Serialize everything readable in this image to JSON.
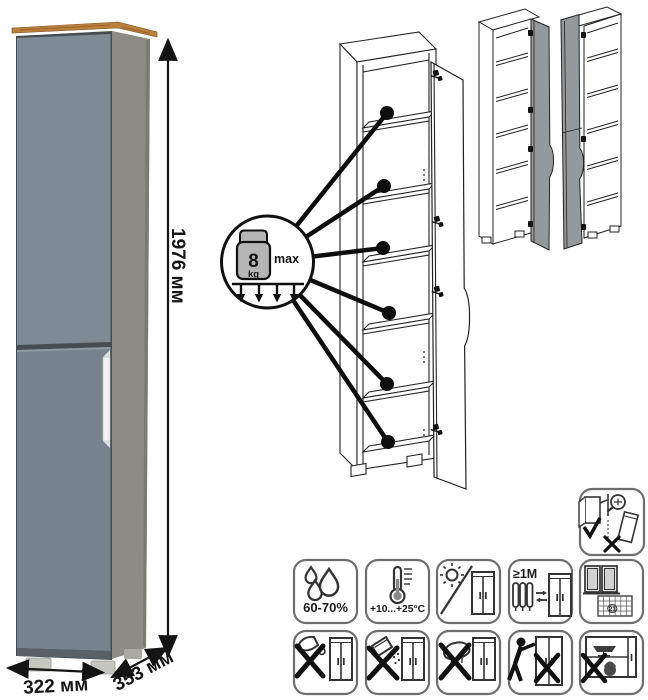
{
  "product": {
    "type_note": "tall one-door cabinet instruction sheet",
    "dimensions": {
      "height": "1976 мм",
      "width": "322 мм",
      "depth": "353 мм"
    }
  },
  "shelf_callout": {
    "weight": "8",
    "unit": "kg",
    "max_label": "max",
    "shelf_count": 6
  },
  "care": {
    "humidity": "60-70%",
    "temperature": "+10...+25°C",
    "distance": "≥1М",
    "calendar_day": "21"
  },
  "icon_names": [
    "wall-anchor-required-icon",
    "humidity-range-icon",
    "temperature-range-icon",
    "no-direct-sunlight-icon",
    "keep-distance-from-heater-icon",
    "ventilate-room-icon",
    "no-aggressive-liquids-icon",
    "no-abrasive-powder-icon",
    "no-wet-sponge-icon",
    "no-dragging-icon",
    "no-overloading-icon"
  ],
  "colors": {
    "door_front": "#76838C",
    "door_front_light": "#7E8B94",
    "side_panel": "#8C8C85",
    "top_wood": "#B9803E",
    "handle": "#F2F3F2",
    "plinth": "#5A6166",
    "foot": "#C6C6C0",
    "variant_door_gray": "#95999C",
    "outline": "#222222"
  }
}
